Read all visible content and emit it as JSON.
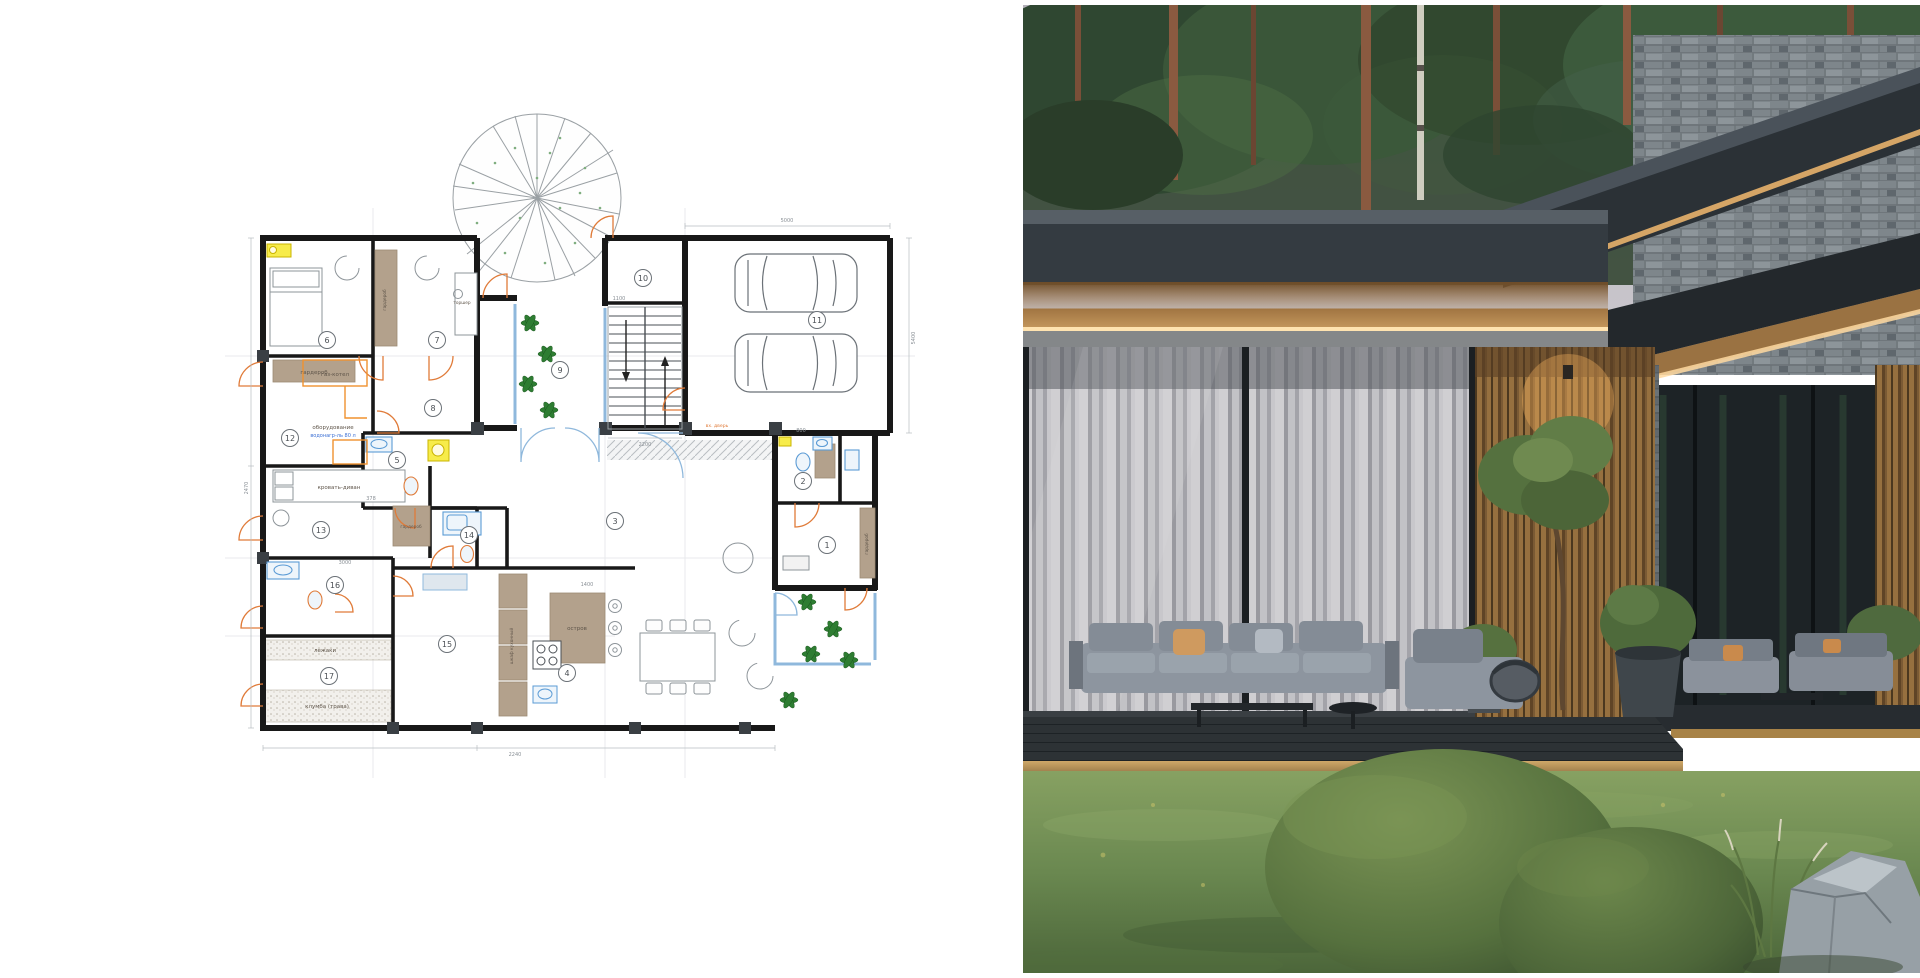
{
  "plan": {
    "rooms": [
      "1",
      "2",
      "3",
      "4",
      "5",
      "6",
      "7",
      "8",
      "9",
      "10",
      "11",
      "12",
      "13",
      "14",
      "15",
      "16",
      "17"
    ],
    "labels": {
      "garderob": "гардероб",
      "gas_boiler": "газ-котел",
      "equipment": "оборудование",
      "water_heater": "водонагр-ль 80 л",
      "bed_sofa": "кровать-диван",
      "island": "остров",
      "kitchen_cab": "шкаф кухонный",
      "loungers": "лежаки",
      "flowerbed": "клумба (трава)",
      "floor_lamp": "торшер",
      "entry_door": "вх. дверь"
    },
    "dims": [
      "2200",
      "1400",
      "3000",
      "5400",
      "2470",
      "1100",
      "378",
      "800",
      "5000",
      "2240"
    ]
  },
  "colors": {
    "wall": "#181818",
    "door_arc": "#e07b39",
    "fixture_blue": "#5b9bd5",
    "glass_blue": "#8fb8dc",
    "furniture_wood": "#b3a18c",
    "plant_green": "#2e7d32",
    "highlight_yellow": "#f7ec4a",
    "roof_charcoal": "#343b41",
    "wood_facade": "#a5763f",
    "deck_gold": "#b28d4f",
    "sofa_gray": "#97a0aa",
    "lawn_green": "#5e7a44"
  }
}
